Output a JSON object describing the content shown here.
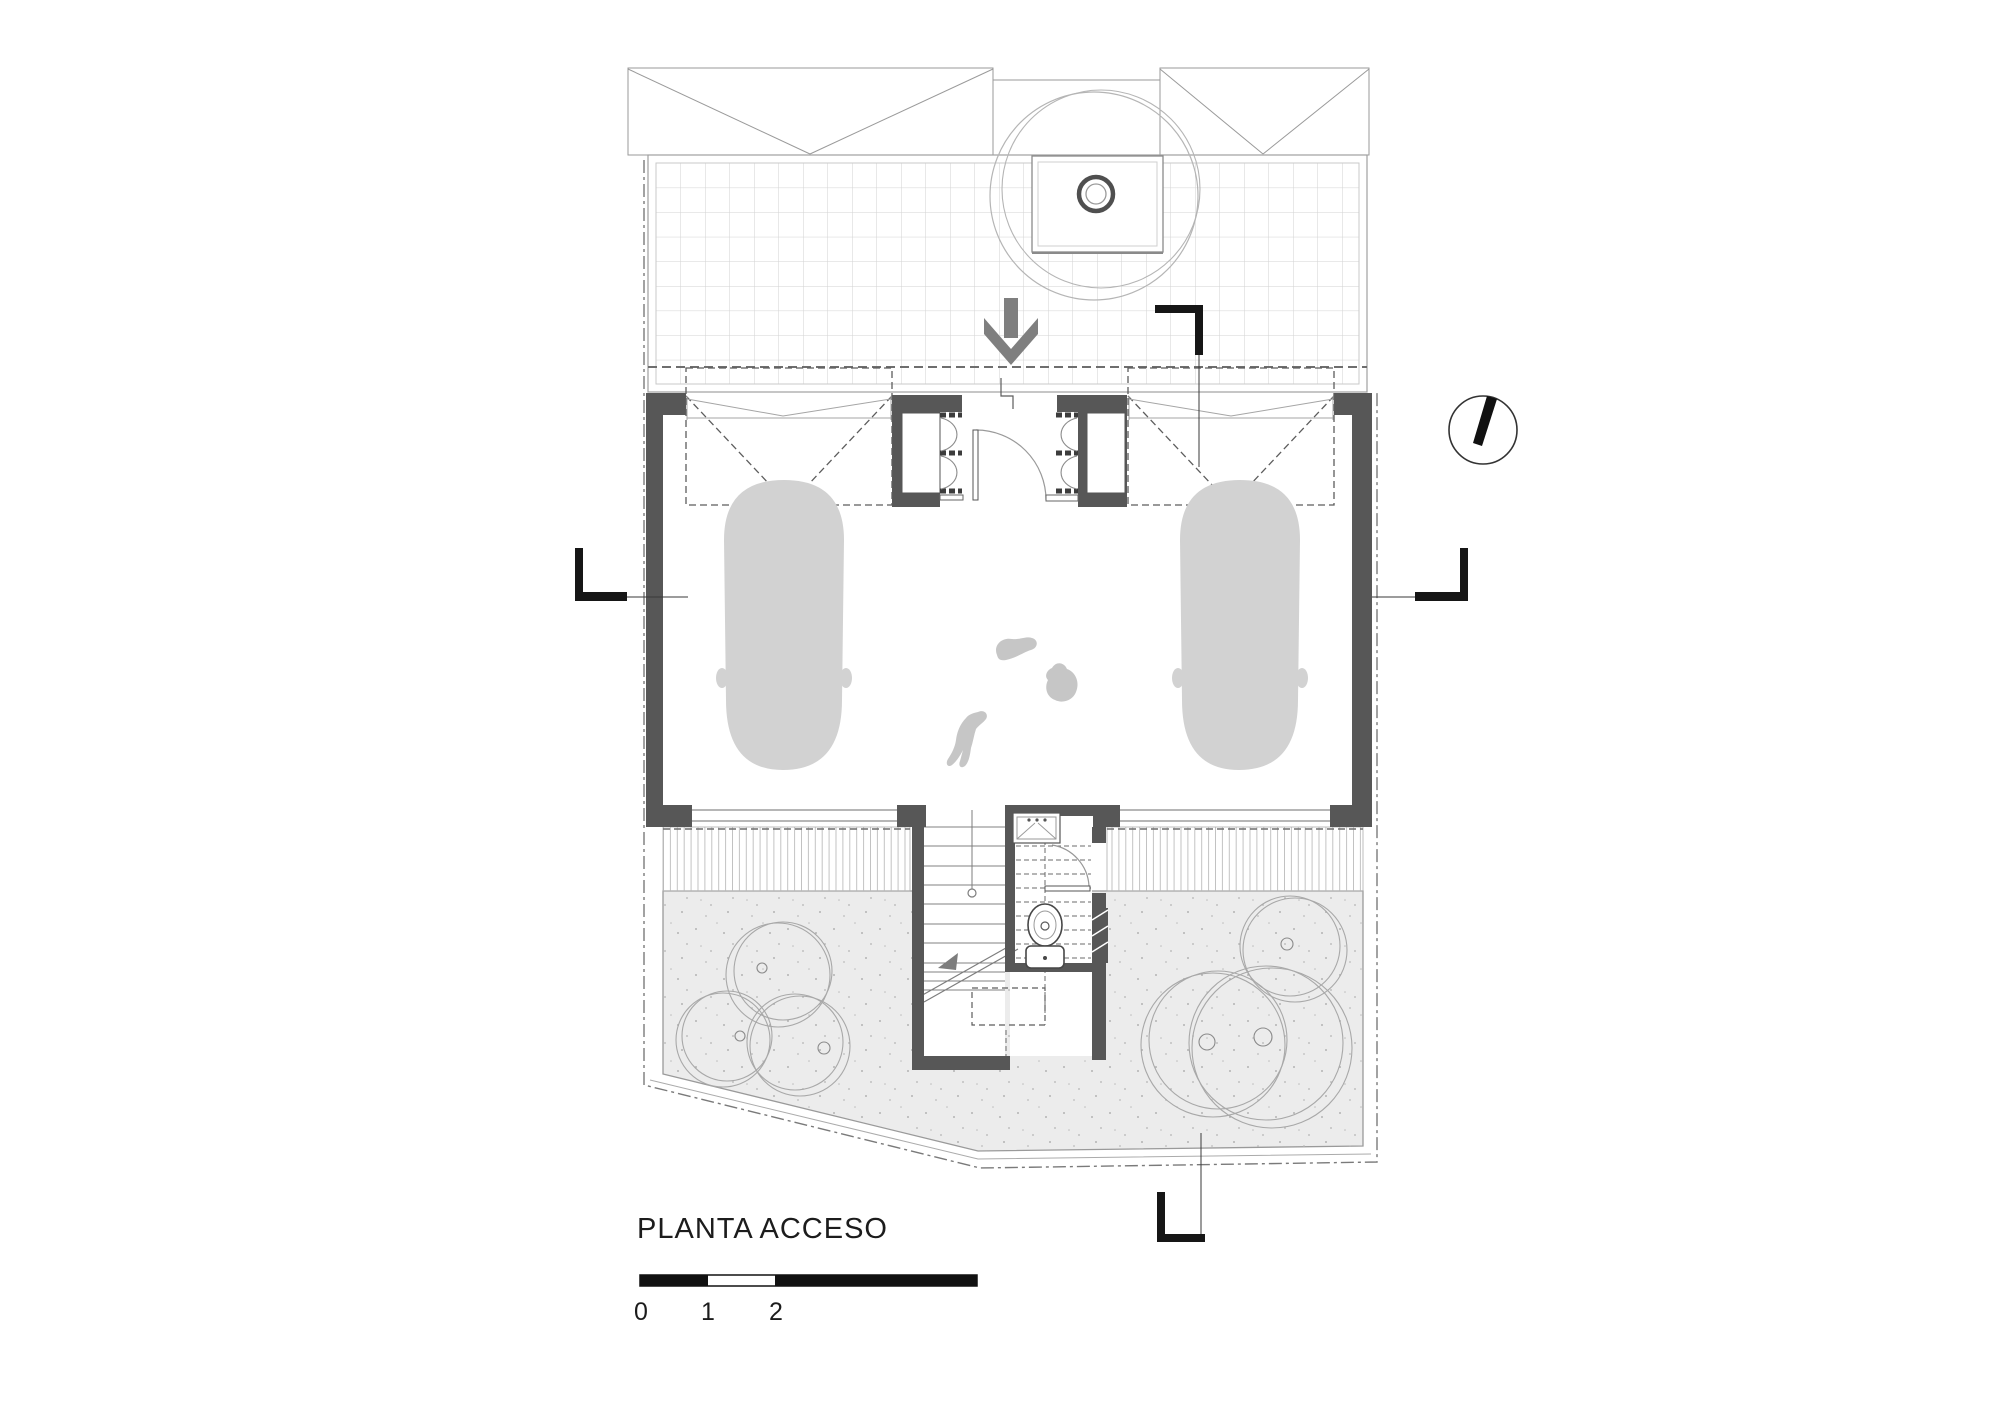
{
  "plan": {
    "title": "PLANTA ACCESO",
    "scale_bar": {
      "labels": [
        "0",
        "1",
        "2",
        "5"
      ]
    }
  },
  "icons": {
    "north_arrow": "north-arrow",
    "entry_arrow": "entry-direction-arrow",
    "section_markers": [
      "section-marker-top",
      "section-marker-left",
      "section-marker-right",
      "section-marker-bottom"
    ]
  },
  "colors": {
    "wall": "#575757",
    "marker_black": "#161616",
    "car": "#d2d2d2",
    "animal": "#c6c6c6",
    "gravel": "#ececec",
    "arrow": "#7f7f7f",
    "tree_line": "#b0b0b0"
  }
}
